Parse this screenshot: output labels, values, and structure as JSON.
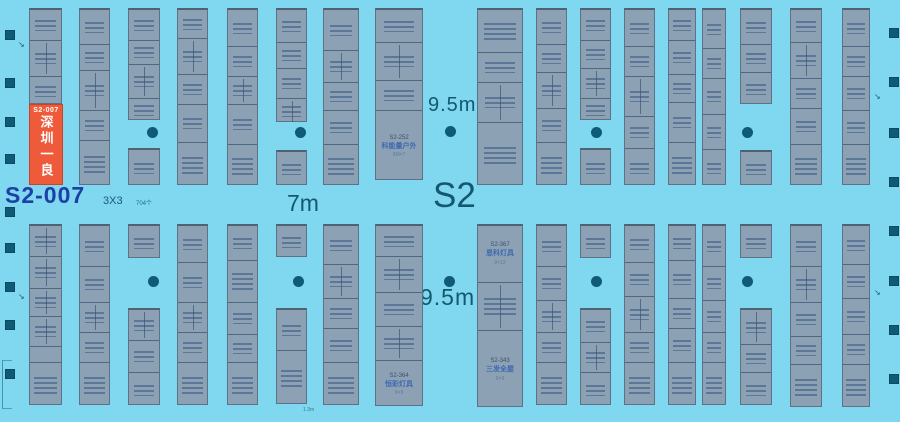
{
  "labels": {
    "hall": "S2",
    "aisle_7m": "7m",
    "aisle_95m_top": "9.5m",
    "aisle_95m_bottom": "9.5m",
    "selected_booth_id": "S2-007",
    "booth_size": "3X3",
    "booth_count": "704个",
    "edge_note": "1.3m"
  },
  "icons": {
    "pointer": "↘"
  },
  "highlight": {
    "id": "S2-007",
    "name": "深圳一良",
    "color": "#ee5a3a"
  },
  "colors": {
    "background": "#7fd7f0",
    "booth_fill": "#8ca1b4",
    "booth_border": "#5d7286",
    "highlight": "#ee5a3a",
    "highlight_text": "#ffffff",
    "aisle_label": "#14586f",
    "selected_label": "#1e3fa6",
    "pillar": "#0f5a74",
    "booth_name_text": "#3e6ab0"
  },
  "floorplan": {
    "strips": [
      {
        "x": 29,
        "y": 8,
        "w": 33,
        "h": 96,
        "cells": [
          {
            "h": 30
          },
          {
            "h": 36,
            "split": true
          },
          {
            "h": 30
          }
        ]
      },
      {
        "x": 79,
        "y": 8,
        "w": 31,
        "h": 177,
        "cells": [
          {
            "h": 34
          },
          {
            "h": 26
          },
          {
            "h": 40,
            "split": true
          },
          {
            "h": 30
          },
          {
            "h": 47
          }
        ]
      },
      {
        "x": 128,
        "y": 8,
        "w": 32,
        "h": 112,
        "cells": [
          {
            "h": 30
          },
          {
            "h": 24
          },
          {
            "h": 34,
            "split": true
          },
          {
            "h": 24
          }
        ]
      },
      {
        "x": 128,
        "y": 148,
        "w": 32,
        "h": 37,
        "cells": [
          {
            "h": 37
          }
        ]
      },
      {
        "x": 177,
        "y": 8,
        "w": 31,
        "h": 177,
        "cells": [
          {
            "h": 28
          },
          {
            "h": 36,
            "split": true
          },
          {
            "h": 30
          },
          {
            "h": 38
          },
          {
            "h": 45
          }
        ]
      },
      {
        "x": 227,
        "y": 8,
        "w": 31,
        "h": 177,
        "cells": [
          {
            "h": 36
          },
          {
            "h": 30
          },
          {
            "h": 28,
            "split": true
          },
          {
            "h": 40
          },
          {
            "h": 43
          }
        ]
      },
      {
        "x": 276,
        "y": 8,
        "w": 31,
        "h": 114,
        "cells": [
          {
            "h": 32
          },
          {
            "h": 26
          },
          {
            "h": 30
          },
          {
            "h": 26,
            "split": true
          }
        ]
      },
      {
        "x": 276,
        "y": 150,
        "w": 31,
        "h": 35,
        "cells": [
          {
            "h": 35
          }
        ]
      },
      {
        "x": 323,
        "y": 8,
        "w": 36,
        "h": 177,
        "cells": [
          {
            "h": 40
          },
          {
            "h": 32,
            "split": true
          },
          {
            "h": 28
          },
          {
            "h": 34
          },
          {
            "h": 43
          }
        ]
      },
      {
        "x": 375,
        "y": 8,
        "w": 48,
        "h": 172,
        "cells": [
          {
            "h": 32
          },
          {
            "h": 38,
            "split": true
          },
          {
            "h": 30
          },
          {
            "h": 72,
            "lines": [
              "S2-252",
              "科能量户外",
              "9M×7"
            ]
          }
        ]
      },
      {
        "x": 477,
        "y": 8,
        "w": 46,
        "h": 177,
        "cells": [
          {
            "h": 42
          },
          {
            "h": 30
          },
          {
            "h": 40,
            "split": true
          },
          {
            "h": 65
          }
        ]
      },
      {
        "x": 536,
        "y": 8,
        "w": 31,
        "h": 177,
        "cells": [
          {
            "h": 34
          },
          {
            "h": 28
          },
          {
            "h": 36,
            "split": true
          },
          {
            "h": 34
          },
          {
            "h": 45
          }
        ]
      },
      {
        "x": 580,
        "y": 8,
        "w": 31,
        "h": 112,
        "cells": [
          {
            "h": 30
          },
          {
            "h": 28
          },
          {
            "h": 30,
            "split": true
          },
          {
            "h": 24
          }
        ]
      },
      {
        "x": 580,
        "y": 148,
        "w": 31,
        "h": 37,
        "cells": [
          {
            "h": 37
          }
        ]
      },
      {
        "x": 624,
        "y": 8,
        "w": 31,
        "h": 177,
        "cells": [
          {
            "h": 36
          },
          {
            "h": 30
          },
          {
            "h": 40,
            "split": true
          },
          {
            "h": 32
          },
          {
            "h": 39
          }
        ]
      },
      {
        "x": 668,
        "y": 8,
        "w": 28,
        "h": 177,
        "cells": [
          {
            "h": 30
          },
          {
            "h": 34
          },
          {
            "h": 28
          },
          {
            "h": 40
          },
          {
            "h": 45
          }
        ]
      },
      {
        "x": 702,
        "y": 8,
        "w": 24,
        "h": 177,
        "cells": [
          {
            "h": 38
          },
          {
            "h": 30
          },
          {
            "h": 36
          },
          {
            "h": 35
          },
          {
            "h": 38
          }
        ]
      },
      {
        "x": 740,
        "y": 8,
        "w": 32,
        "h": 96,
        "cells": [
          {
            "h": 34
          },
          {
            "h": 28
          },
          {
            "h": 34
          }
        ]
      },
      {
        "x": 740,
        "y": 150,
        "w": 32,
        "h": 35,
        "cells": [
          {
            "h": 35
          }
        ]
      },
      {
        "x": 790,
        "y": 8,
        "w": 32,
        "h": 177,
        "cells": [
          {
            "h": 32
          },
          {
            "h": 36,
            "split": true
          },
          {
            "h": 30
          },
          {
            "h": 36
          },
          {
            "h": 43
          }
        ]
      },
      {
        "x": 842,
        "y": 8,
        "w": 28,
        "h": 177,
        "cells": [
          {
            "h": 36
          },
          {
            "h": 30
          },
          {
            "h": 34
          },
          {
            "h": 34
          },
          {
            "h": 43
          }
        ]
      },
      {
        "x": 29,
        "y": 224,
        "w": 33,
        "h": 181,
        "cells": [
          {
            "h": 30,
            "split": true
          },
          {
            "h": 32,
            "split": true
          },
          {
            "h": 28,
            "split": true
          },
          {
            "h": 30,
            "split": true
          },
          {
            "h": 16
          },
          {
            "h": 45
          }
        ]
      },
      {
        "x": 79,
        "y": 224,
        "w": 31,
        "h": 181,
        "cells": [
          {
            "h": 40
          },
          {
            "h": 36
          },
          {
            "h": 30,
            "split": true
          },
          {
            "h": 30
          },
          {
            "h": 45
          }
        ]
      },
      {
        "x": 128,
        "y": 224,
        "w": 32,
        "h": 34,
        "cells": [
          {
            "h": 34
          }
        ]
      },
      {
        "x": 128,
        "y": 308,
        "w": 32,
        "h": 97,
        "cells": [
          {
            "h": 30,
            "split": true
          },
          {
            "h": 32
          },
          {
            "h": 35
          }
        ]
      },
      {
        "x": 177,
        "y": 224,
        "w": 31,
        "h": 181,
        "cells": [
          {
            "h": 36
          },
          {
            "h": 40
          },
          {
            "h": 30,
            "split": true
          },
          {
            "h": 30
          },
          {
            "h": 45
          }
        ]
      },
      {
        "x": 227,
        "y": 224,
        "w": 31,
        "h": 181,
        "cells": [
          {
            "h": 34
          },
          {
            "h": 42
          },
          {
            "h": 32
          },
          {
            "h": 28
          },
          {
            "h": 45
          }
        ]
      },
      {
        "x": 276,
        "y": 224,
        "w": 31,
        "h": 33,
        "cells": [
          {
            "h": 33
          }
        ]
      },
      {
        "x": 276,
        "y": 308,
        "w": 31,
        "h": 96,
        "cells": [
          {
            "h": 40
          },
          {
            "h": 56
          }
        ]
      },
      {
        "x": 323,
        "y": 224,
        "w": 36,
        "h": 181,
        "cells": [
          {
            "h": 38
          },
          {
            "h": 34,
            "split": true
          },
          {
            "h": 30
          },
          {
            "h": 34
          },
          {
            "h": 45
          }
        ]
      },
      {
        "x": 375,
        "y": 224,
        "w": 48,
        "h": 182,
        "cells": [
          {
            "h": 30
          },
          {
            "h": 36,
            "split": true
          },
          {
            "h": 34
          },
          {
            "h": 34,
            "split": true
          },
          {
            "h": 48,
            "lines": [
              "S2-364",
              "恒彩灯具",
              "9×9"
            ]
          }
        ]
      },
      {
        "x": 477,
        "y": 224,
        "w": 46,
        "h": 183,
        "cells": [
          {
            "h": 56,
            "lines": [
              "S2-367",
              "恩科灯具",
              "9×12"
            ]
          },
          {
            "h": 48,
            "split": true
          },
          {
            "h": 79,
            "lines": [
              "S2-343",
              "三发全屋",
              "9×9"
            ]
          }
        ]
      },
      {
        "x": 536,
        "y": 224,
        "w": 31,
        "h": 181,
        "cells": [
          {
            "h": 40
          },
          {
            "h": 34
          },
          {
            "h": 32,
            "split": true
          },
          {
            "h": 30
          },
          {
            "h": 45
          }
        ]
      },
      {
        "x": 580,
        "y": 224,
        "w": 31,
        "h": 34,
        "cells": [
          {
            "h": 34
          }
        ]
      },
      {
        "x": 580,
        "y": 308,
        "w": 31,
        "h": 97,
        "cells": [
          {
            "h": 32
          },
          {
            "h": 30,
            "split": true
          },
          {
            "h": 35
          }
        ]
      },
      {
        "x": 624,
        "y": 224,
        "w": 31,
        "h": 181,
        "cells": [
          {
            "h": 36
          },
          {
            "h": 34
          },
          {
            "h": 36,
            "split": true
          },
          {
            "h": 30
          },
          {
            "h": 45
          }
        ]
      },
      {
        "x": 668,
        "y": 224,
        "w": 28,
        "h": 181,
        "cells": [
          {
            "h": 34
          },
          {
            "h": 38
          },
          {
            "h": 30
          },
          {
            "h": 34
          },
          {
            "h": 45
          }
        ]
      },
      {
        "x": 702,
        "y": 224,
        "w": 24,
        "h": 181,
        "cells": [
          {
            "h": 40
          },
          {
            "h": 34
          },
          {
            "h": 32
          },
          {
            "h": 30
          },
          {
            "h": 45
          }
        ]
      },
      {
        "x": 740,
        "y": 224,
        "w": 32,
        "h": 34,
        "cells": [
          {
            "h": 34
          }
        ]
      },
      {
        "x": 740,
        "y": 308,
        "w": 32,
        "h": 97,
        "cells": [
          {
            "h": 34,
            "split": true
          },
          {
            "h": 28
          },
          {
            "h": 35
          }
        ]
      },
      {
        "x": 790,
        "y": 224,
        "w": 32,
        "h": 183,
        "cells": [
          {
            "h": 40
          },
          {
            "h": 36,
            "split": true
          },
          {
            "h": 34
          },
          {
            "h": 28
          },
          {
            "h": 45
          }
        ]
      },
      {
        "x": 842,
        "y": 224,
        "w": 28,
        "h": 183,
        "cells": [
          {
            "h": 38
          },
          {
            "h": 34
          },
          {
            "h": 36
          },
          {
            "h": 30
          },
          {
            "h": 45
          }
        ]
      }
    ],
    "left_pillars": [
      35,
      83,
      122,
      159,
      212,
      248,
      287,
      325,
      374
    ],
    "right_pillars": [
      33,
      82,
      133,
      182,
      231,
      281,
      330,
      379
    ],
    "dots": [
      [
        152,
        132
      ],
      [
        300,
        132
      ],
      [
        450,
        131
      ],
      [
        596,
        132
      ],
      [
        747,
        132
      ],
      [
        153,
        281
      ],
      [
        298,
        281
      ],
      [
        449,
        281
      ],
      [
        596,
        281
      ],
      [
        747,
        281
      ]
    ],
    "pointers": [
      [
        18,
        40
      ],
      [
        18,
        292
      ],
      [
        874,
        92
      ],
      [
        874,
        288
      ]
    ]
  }
}
